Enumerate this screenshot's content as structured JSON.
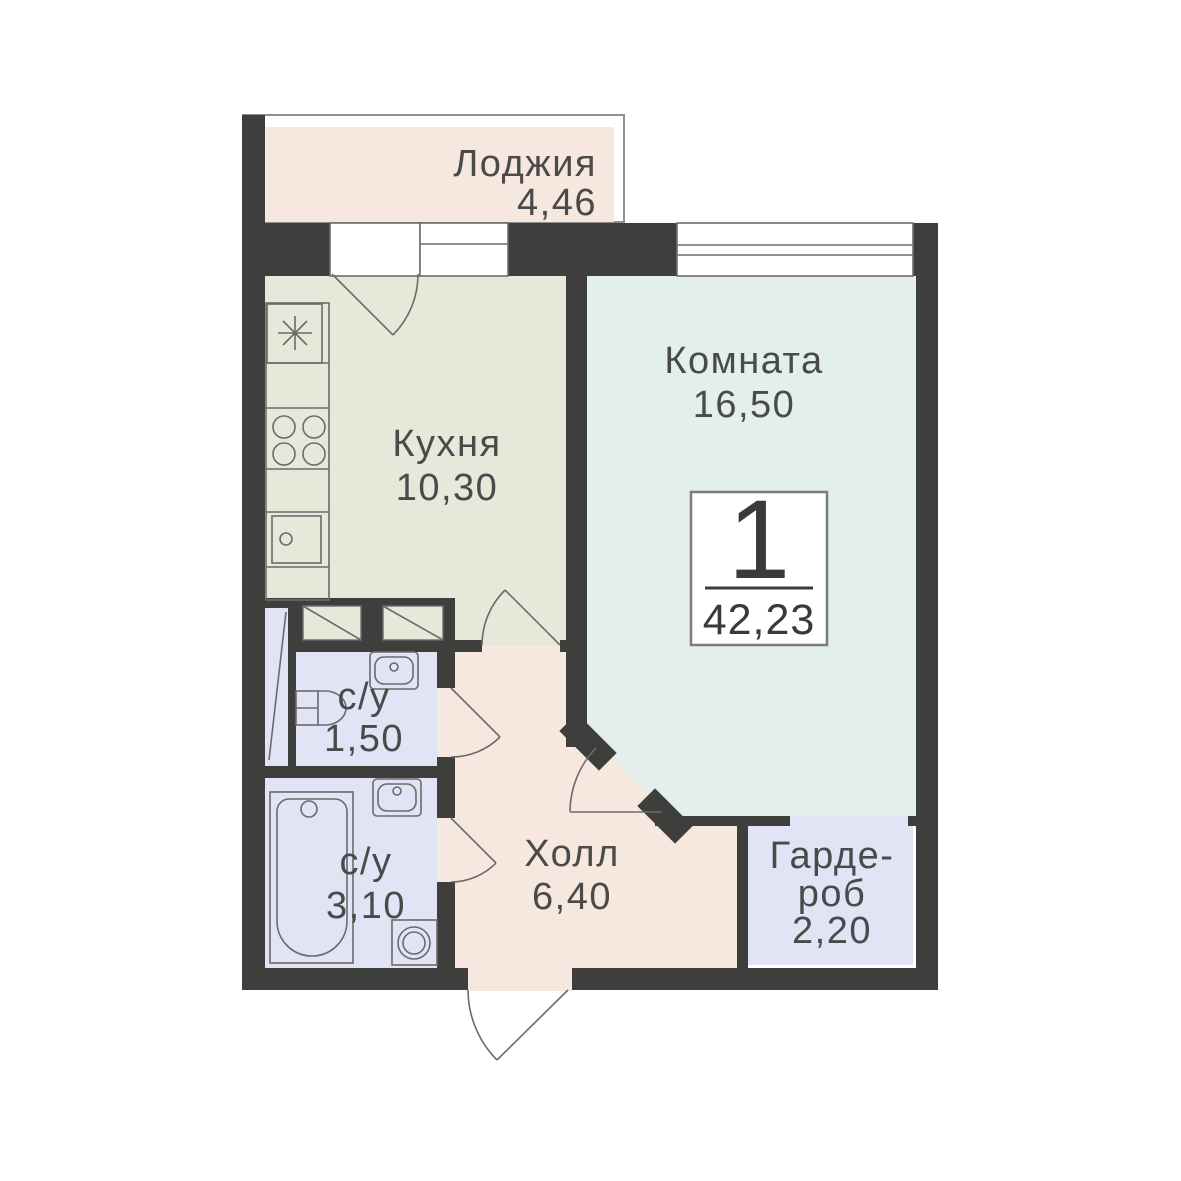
{
  "rooms": {
    "loggia": {
      "name": "Лоджия",
      "area": "4,46"
    },
    "kitchen": {
      "name": "Кухня",
      "area": "10,30"
    },
    "living_room": {
      "name": "Комната",
      "area": "16,50"
    },
    "bathroom_small": {
      "name": "с/у",
      "area": "1,50"
    },
    "bathroom_large": {
      "name": "с/у",
      "area": "3,10"
    },
    "hall": {
      "name": "Холл",
      "area": "6,40"
    },
    "wardrobe": {
      "name_line_1": "Гарде-",
      "name_line_2": "роб",
      "area": "2,20"
    }
  },
  "summary_badge": {
    "room_count": "1",
    "total_area": "42,23"
  },
  "colors": {
    "wall": "#3e3e3c",
    "loggia_hall_fill": "#f7e8df",
    "kitchen_fill": "#e4e9d9",
    "room_fill": "#e2efec",
    "wet_rooms_fill": "#e1e4f4",
    "fixture_line": "#6b6b6b",
    "text": "#4a4a4a",
    "badge_border": "#7c7c7c",
    "background": "#ffffff"
  }
}
